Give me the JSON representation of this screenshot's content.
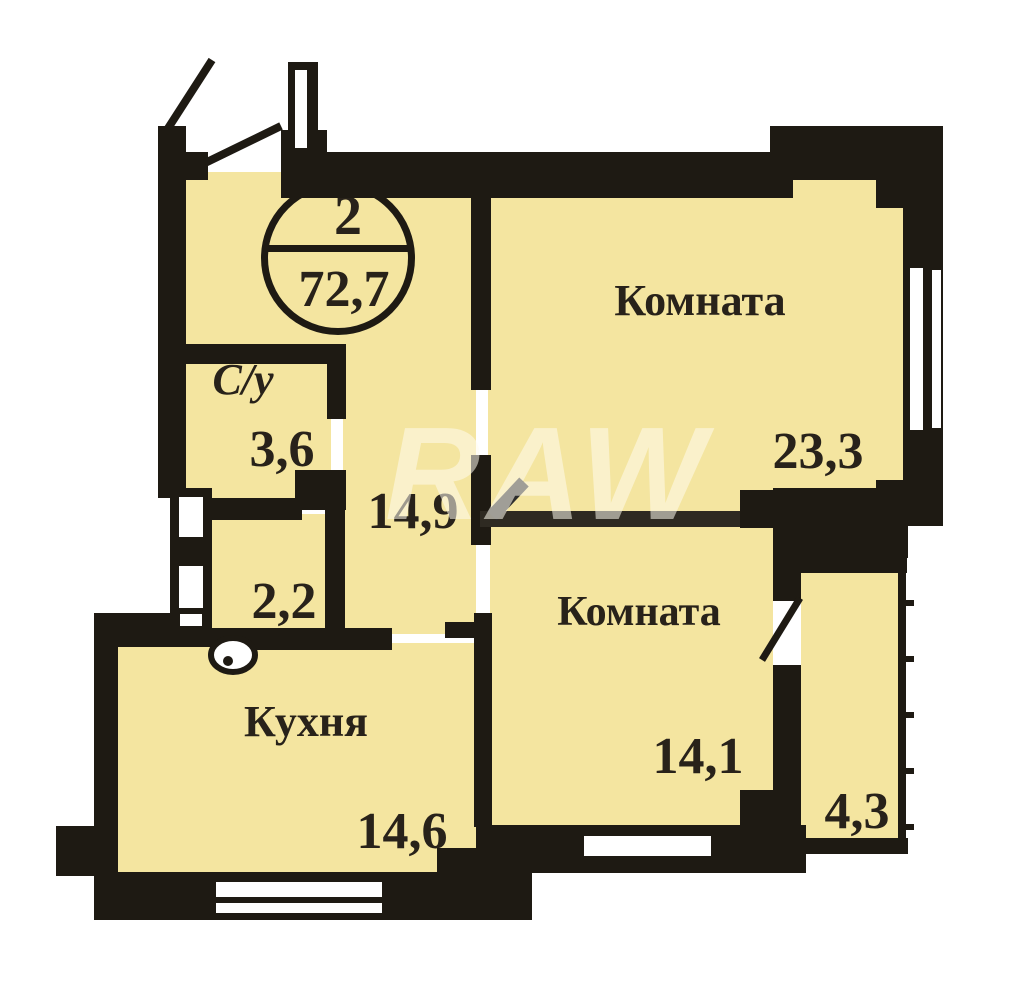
{
  "plan": {
    "badge": {
      "rooms_count": "2",
      "total_area": "72,7"
    },
    "rooms": {
      "room1": {
        "label": "Комната",
        "area": "23,3"
      },
      "room2": {
        "label": "Комната",
        "area": "14,1"
      },
      "kitchen": {
        "label": "Кухня",
        "area": "14,6"
      },
      "bathroom": {
        "label": "С/у",
        "area": "3,6"
      },
      "hallway": {
        "area": "14,9"
      },
      "corridor": {
        "area": "2,2"
      },
      "balcony": {
        "area": "4,3"
      }
    },
    "watermark": "RAW",
    "colors": {
      "room_fill": "#f4e5a0",
      "wall": "#1e1a13",
      "text": "#28221a",
      "watermark": "rgba(255,251,238,0.55)"
    }
  }
}
